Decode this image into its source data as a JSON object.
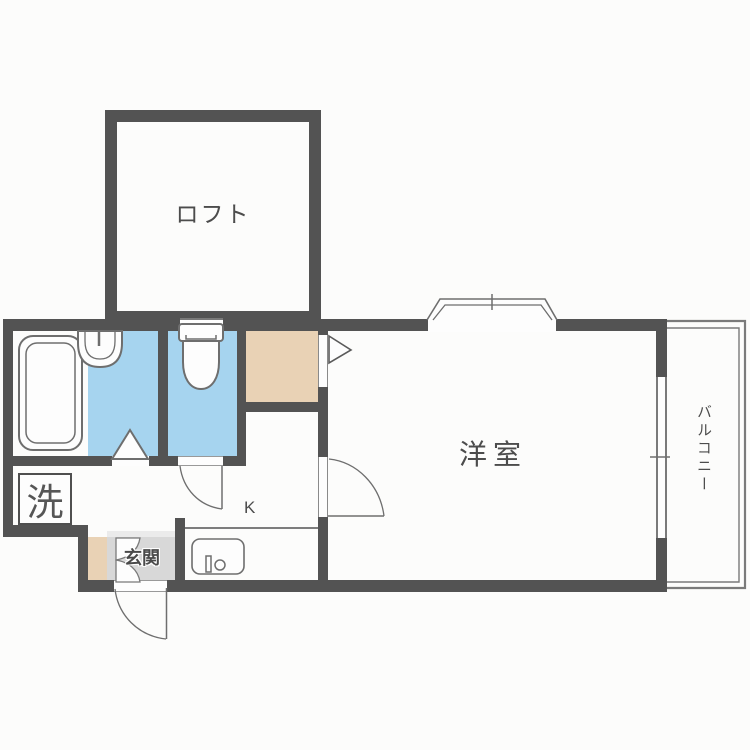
{
  "floorplan": {
    "title": "apartment-floor-plan",
    "rooms": {
      "loft": {
        "label": "ロフト"
      },
      "western_room": {
        "label": "洋室"
      },
      "balcony": {
        "label": "バルコニー"
      },
      "entrance": {
        "label": "玄関"
      },
      "kitchen": {
        "label": "K"
      },
      "laundry": {
        "label": "洗"
      }
    },
    "fixtures": [
      "bathtub",
      "washbasin",
      "toilet",
      "kitchen-sink",
      "shoe-cabinet",
      "closet",
      "bay-window",
      "sliding-window",
      "hinged-doors",
      "folding-door"
    ],
    "colors": {
      "wall": "#535353",
      "wet_area_floor": "#a6d4ef",
      "closet_floor": "#e9d2b5",
      "entrance_floor": "#d8d8d8",
      "entrance_step": "#ebebeb",
      "outline": "#6e6e6e",
      "background": "#fcfcfb",
      "text": "#4c4c4c"
    }
  }
}
